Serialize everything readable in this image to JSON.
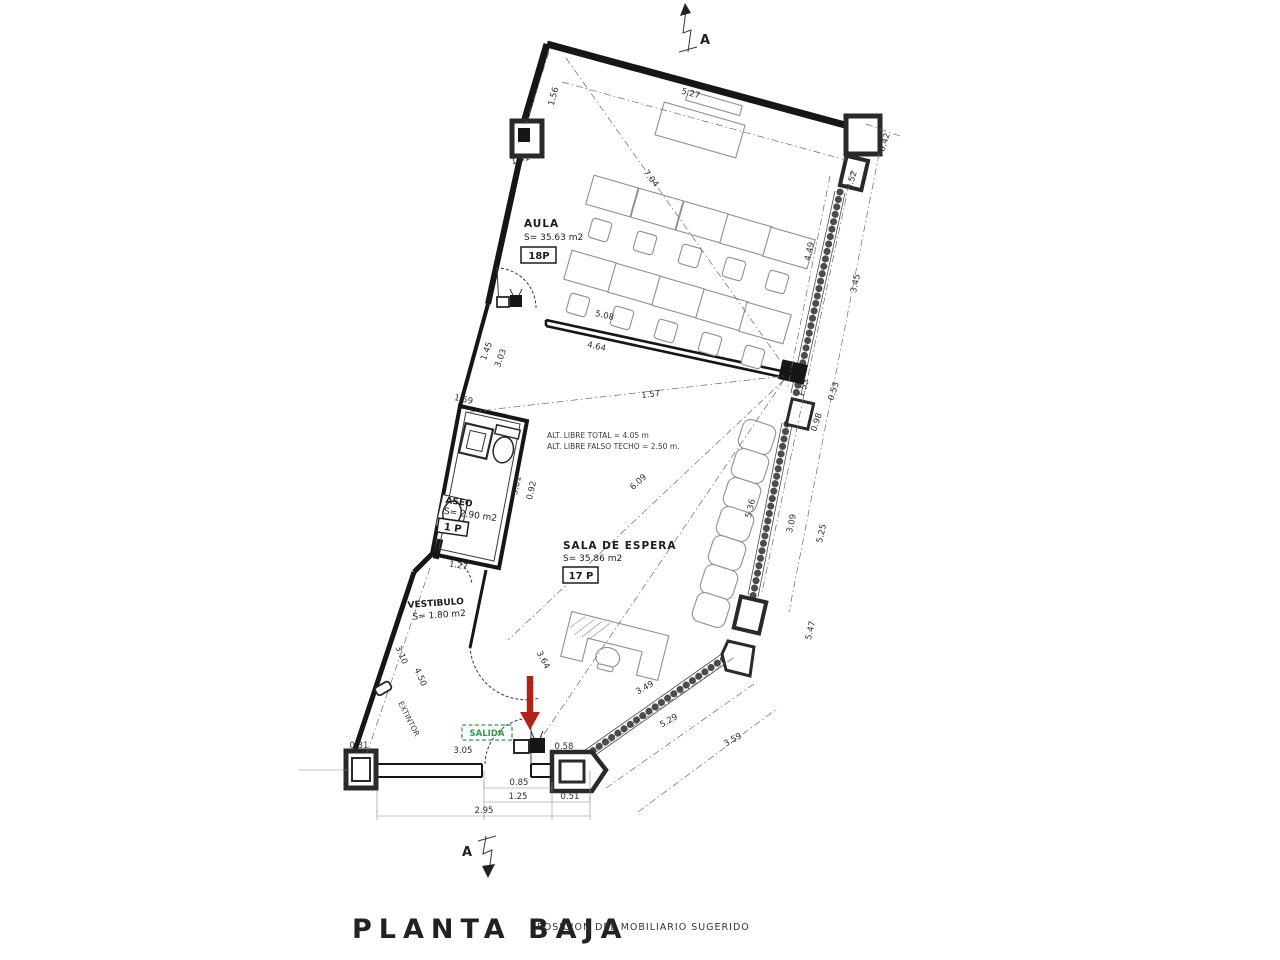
{
  "drawing": {
    "title": "PLANTA BAJA",
    "subtitle": "POSICION DEL MOBILIARIO SUGERIDO",
    "section_marker_top": "A",
    "section_marker_bottom": "A"
  },
  "rooms": {
    "aula": {
      "name": "AULA",
      "area": "S= 35.63 m2",
      "capacity": "18P"
    },
    "sala": {
      "name": "SALA DE ESPERA",
      "area": "S= 35.86 m2",
      "capacity": "17 P"
    },
    "aseo": {
      "name": "ASEO",
      "area": "S= 2.90 m2",
      "capacity": "1 P"
    },
    "vestibulo": {
      "name": "VESTIBULO",
      "area": "S= 1.80 m2"
    }
  },
  "notes": {
    "height_line1": "ALT. LIBRE TOTAL = 4.05 m",
    "height_line2": "ALT. LIBRE FALSO TECHO = 2.50 m.",
    "exit": "SALIDA",
    "extinguisher": "EXTINTOR"
  },
  "colors": {
    "exit_green": "#2f9e4f",
    "arrow_red": "#b02318",
    "ink": "#161616"
  },
  "dims": {
    "top_wall": "5.27",
    "top_left": "1.56",
    "col_left": "1.41",
    "aula_diag": "7.04",
    "right_0_42": "0.42",
    "right_3_52": "3.52",
    "right_4_49": "4.49",
    "right_3_45": "3.45",
    "divider_top": "5.08",
    "divider_bottom": "4.64",
    "junction_1_53": "1.53",
    "junction_0_98": "0.98",
    "junction_0_53": "0.53",
    "sala_1_57": "1.57",
    "sala_diag": "6.09",
    "aseo_top": "1.59",
    "aseo_right_a": "5.01",
    "aseo_right_b": "0.92",
    "aseo_bottom": "1.27",
    "left_mid_a": "1.45",
    "left_mid_b": "3.03",
    "right_3_09": "3.09",
    "right_5_25": "5.25",
    "right_5_36": "5.36",
    "right_5_47": "5.47",
    "br_3_49": "3.49",
    "br_5_29": "5.29",
    "br_3_59": "3.59",
    "entry_diag": "3.64",
    "left_4_50": "4.50",
    "left_3_10": "3.10",
    "col_0_31": "0.31",
    "bottom_3_05": "3.05",
    "col_0_58": "0.58",
    "door_0_85": "0.85",
    "bottom_1_25": "1.25",
    "bottom_0_51": "0.51",
    "bottom_2_95": "2.95"
  }
}
